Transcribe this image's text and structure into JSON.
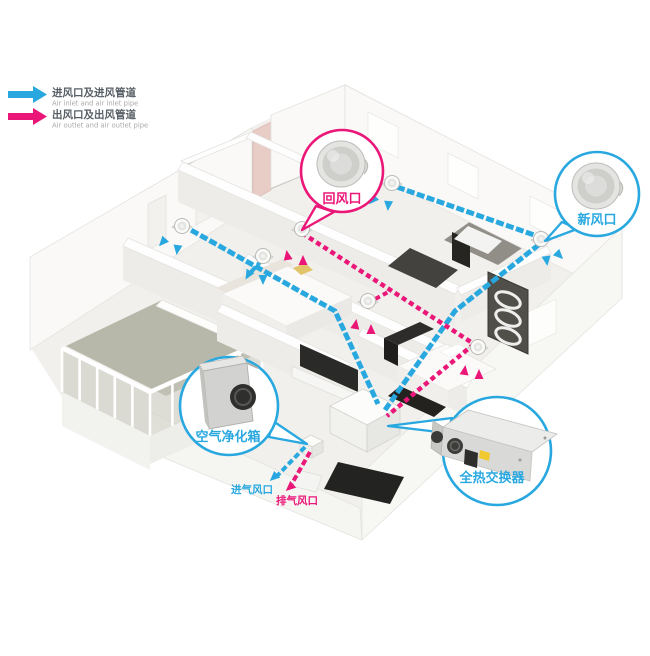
{
  "colors": {
    "inlet_blue": "#29a8e0",
    "outlet_pink": "#ea1678"
  },
  "legend": {
    "inlet": {
      "zh": "进风口及进风管道",
      "en": "Air inlet and air inlet pipe"
    },
    "outlet": {
      "zh": "出风口及出风管道",
      "en": "Air outlet and air outlet pipe"
    }
  },
  "callouts": {
    "return_air": {
      "label": "回风口"
    },
    "fresh_air": {
      "label": "新风口"
    },
    "air_purifier": {
      "label": "空气净化箱"
    },
    "heat_exchanger": {
      "label": "全热交换器"
    }
  },
  "port_labels": {
    "intake": "进气风口",
    "exhaust": "排气风口"
  }
}
